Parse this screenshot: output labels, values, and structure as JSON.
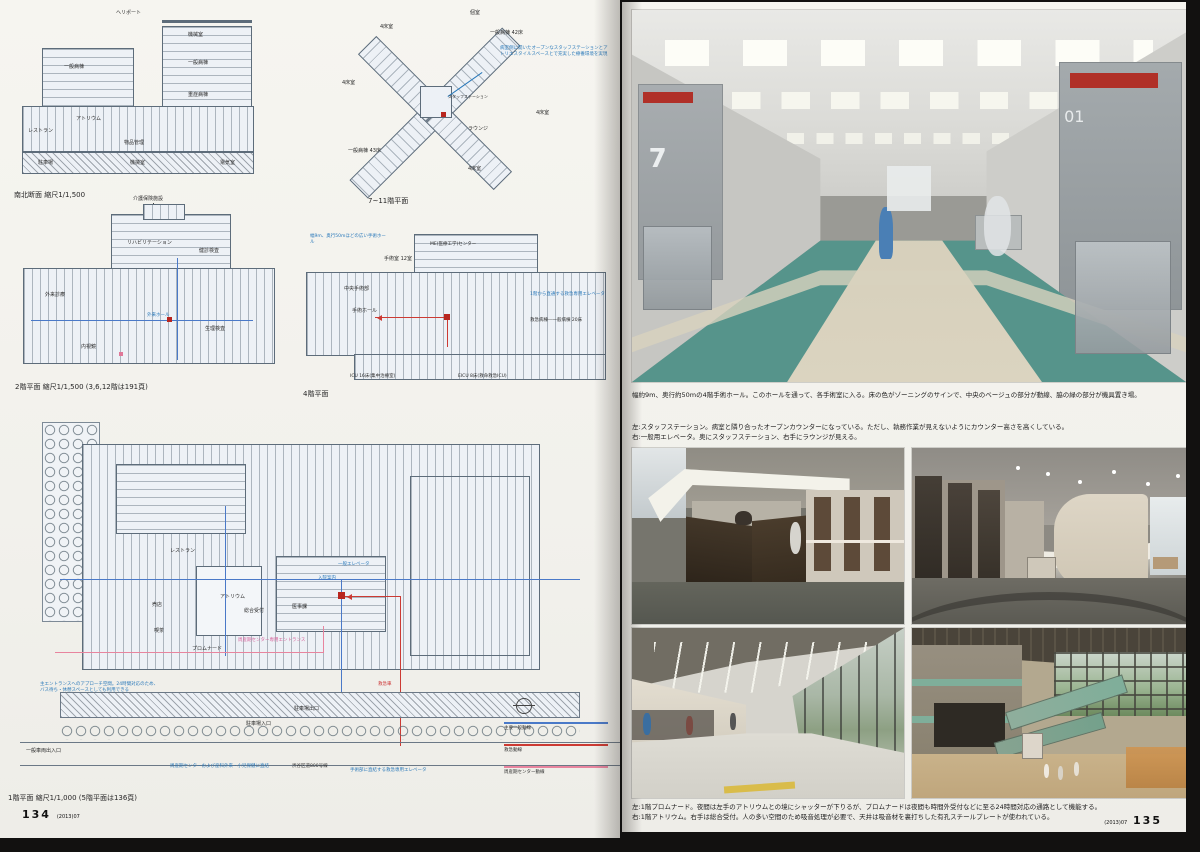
{
  "meta": {
    "page_number_left": "134",
    "page_number_right": "135",
    "issue_note": "(2013)07"
  },
  "left_page": {
    "section_drawing": {
      "caption": "南北断面 縮尺1/1,500",
      "labels": {
        "heliport": "ヘリポート",
        "machine_top": "機械室",
        "ward_l": "一般病棟",
        "ward_r": "一般病棟",
        "icu": "重症病棟",
        "atrium": "アトリウム",
        "restaurant": "レストラン",
        "supply": "物品管理",
        "parking": "駐車場",
        "machine_b": "機械室",
        "electric": "電気室"
      }
    },
    "ward_plan": {
      "caption": "7~11階平面",
      "annotation": "病室側に開いたオープンなスタッフステーションとアトリエスタイルスペースとで充実した療養環境を実現",
      "labels": {
        "private": "個室",
        "ward42": "一般病棟 42床",
        "four_a": "4床室",
        "four_b": "4床室",
        "four_c": "4床室",
        "four_d": "4床室",
        "lounge": "ラウンジ",
        "ward43": "一般病棟 43床",
        "staff": "スタッフステーション"
      }
    },
    "second_floor_plan": {
      "caption": "2階平面 縮尺1/1,500 (3,6,12階は191頁)",
      "annotation_top": "介護保険施設",
      "labels": {
        "rehab": "リハビリテーション",
        "checkup": "健診検査",
        "hall": "外来ホール",
        "endoscope": "内視鏡",
        "physio": "生理検査",
        "outpatient": "外来診療"
      }
    },
    "fourth_floor_plan": {
      "caption": "4階平面",
      "annotation_hall": "幅9m、奥行50mほどの広い手術ホール",
      "annotation_elevator": "1階から直通する救急専用エレベータ",
      "labels": {
        "me_center": "ME(医療工学)センター",
        "op12": "手術室 12室",
        "central_op": "中央手術部",
        "op_hall": "手術ホール",
        "er_ward": "救急病棟―一般病棟 20床",
        "icu": "ICU 16床(集中治療室)",
        "eicu": "EICU 8床(救命救急ICU)"
      }
    },
    "first_floor_plan": {
      "caption": "1階平面 縮尺1/1,000 (5階平面は136頁)",
      "labels": {
        "restaurant": "レストラン",
        "atrium": "アトリウム",
        "reception": "総合受付",
        "medical_affairs": "医事課",
        "shop": "売店",
        "cafe": "喫茶",
        "promenade": "プロムナード",
        "admission": "入院案内",
        "elevator": "一般エレベータ",
        "parking_out": "駐車場出口",
        "parking_in": "駐車場入口",
        "car_gate": "一般車両出入口",
        "ambulance": "救急車",
        "road": "渋谷区道800号線"
      },
      "annotation_entrance": "主エントランスへのアプローチ空間。24時間対応のため、バス待ち・休憩スペースとしても利用できる",
      "annotation_perinatal": "周産期センター専用エントランス",
      "annotation_direct": "周産期センターおよび産科外来・小児保健に直結",
      "annotation_er_elevator": "手術部に直結する救急専用エレベータ",
      "legend": {
        "items": [
          {
            "label": "主要一般動線",
            "color": "#4a79c8"
          },
          {
            "label": "救急動線",
            "color": "#cc3a33"
          },
          {
            "label": "周産期センター動線",
            "color": "#e8849e"
          }
        ]
      }
    }
  },
  "right_page": {
    "photo_top_caption": "幅約9m、奥行約50mの4階手術ホール。このホールを通って、各手術室に入る。床の色がゾーニングのサインで、中央のベージュの部分が動線、脇の緑の部分が機具置き場。",
    "photo_mid_caption_1": "左:スタッフステーション。病室と隣り合ったオープンカウンターになっている。ただし、執務作業が見えないようにカウンター高さを高くしている。",
    "photo_mid_caption_2": "右:一般用エレベータ。奥にスタッフステーション、右手にラウンジが見える。",
    "photo_bottom_caption_1": "左:1階プロムナード。夜間は左手のアトリウムとの境にシャッターが下りるが、プロムナードは夜間も時間外受付などに至る24時間対応の通路として機能する。",
    "photo_bottom_caption_2": "右:1階アトリウム。右手は総合受付。人の多い空間のため吸音処理が必要で、天井は吸音材を裏打ちした有孔スチールプレートが使われている。",
    "op_door_left_number": "7",
    "op_door_right_number": "01"
  }
}
